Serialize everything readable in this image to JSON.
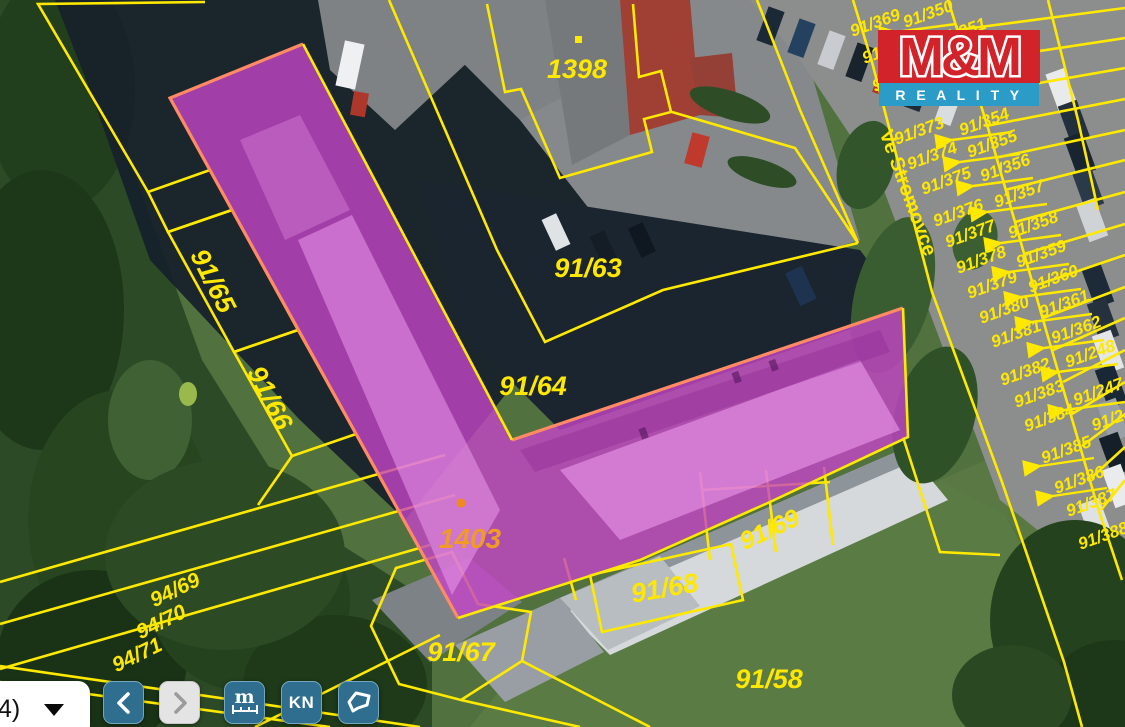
{
  "map": {
    "street": "Ve Stromovce",
    "labels": {
      "left": [
        "91/65",
        "91/66"
      ],
      "center": [
        "1398",
        "91/63",
        "91/64",
        "1403"
      ],
      "bottom": [
        "91/67",
        "91/68",
        "91/69",
        "91/58",
        "94/69",
        "94/70",
        "94/71"
      ],
      "right_inner": [
        "91/369",
        "91/370",
        "91/371",
        "91/373",
        "91/374",
        "91/375",
        "91/376",
        "91/377",
        "91/378",
        "91/379",
        "91/380",
        "91/381",
        "91/382",
        "91/383",
        "91/384",
        "91/385",
        "91/386",
        "91/387",
        "91/388"
      ],
      "right_outer": [
        "91/350",
        "91/351",
        "91/354",
        "91/355",
        "91/356",
        "91/357",
        "91/358",
        "91/359",
        "91/360",
        "91/361",
        "91/362",
        "91/248",
        "91/247",
        "91/24"
      ]
    },
    "colors": {
      "parcel_line": "#ffe900",
      "highlight_fill": "#c445c8",
      "highlight_outline": "#ff8a63",
      "highlight_label": "#f09a28",
      "button_blue": "#2f6e8e",
      "logo_red": "#d2232a",
      "logo_blue": "#2b9cc7"
    }
  },
  "logo": {
    "mm": "M&M",
    "reality": "R E A L I T Y"
  },
  "toolbar": {
    "scale_dropdown_value": "4)",
    "measure_label": "m",
    "kn_label": "KN"
  }
}
